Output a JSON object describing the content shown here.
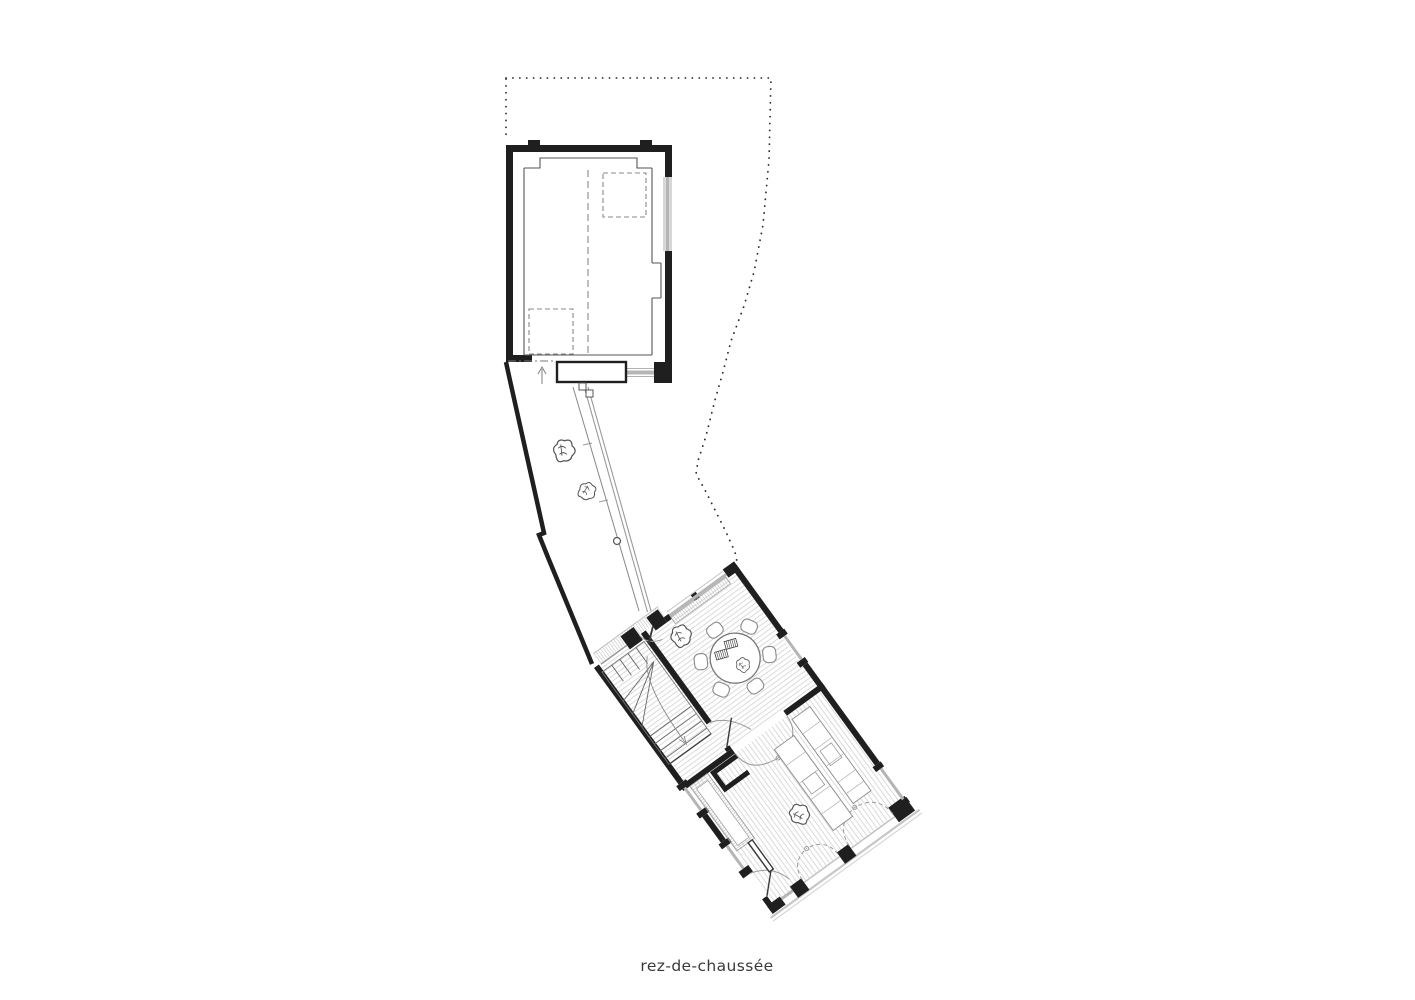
{
  "caption": {
    "text": "rez-de-chaussée"
  },
  "drawing": {
    "kind": "architectural floor plan",
    "colors": {
      "background": "#ffffff",
      "wall_ink": "#1f1f1f",
      "medium_line": "#555555",
      "light_line": "#999999",
      "glazing": "#b5b5b5",
      "floor_hatch": "#cbcbcb",
      "boundary_dots": "#2e2e2e"
    }
  }
}
